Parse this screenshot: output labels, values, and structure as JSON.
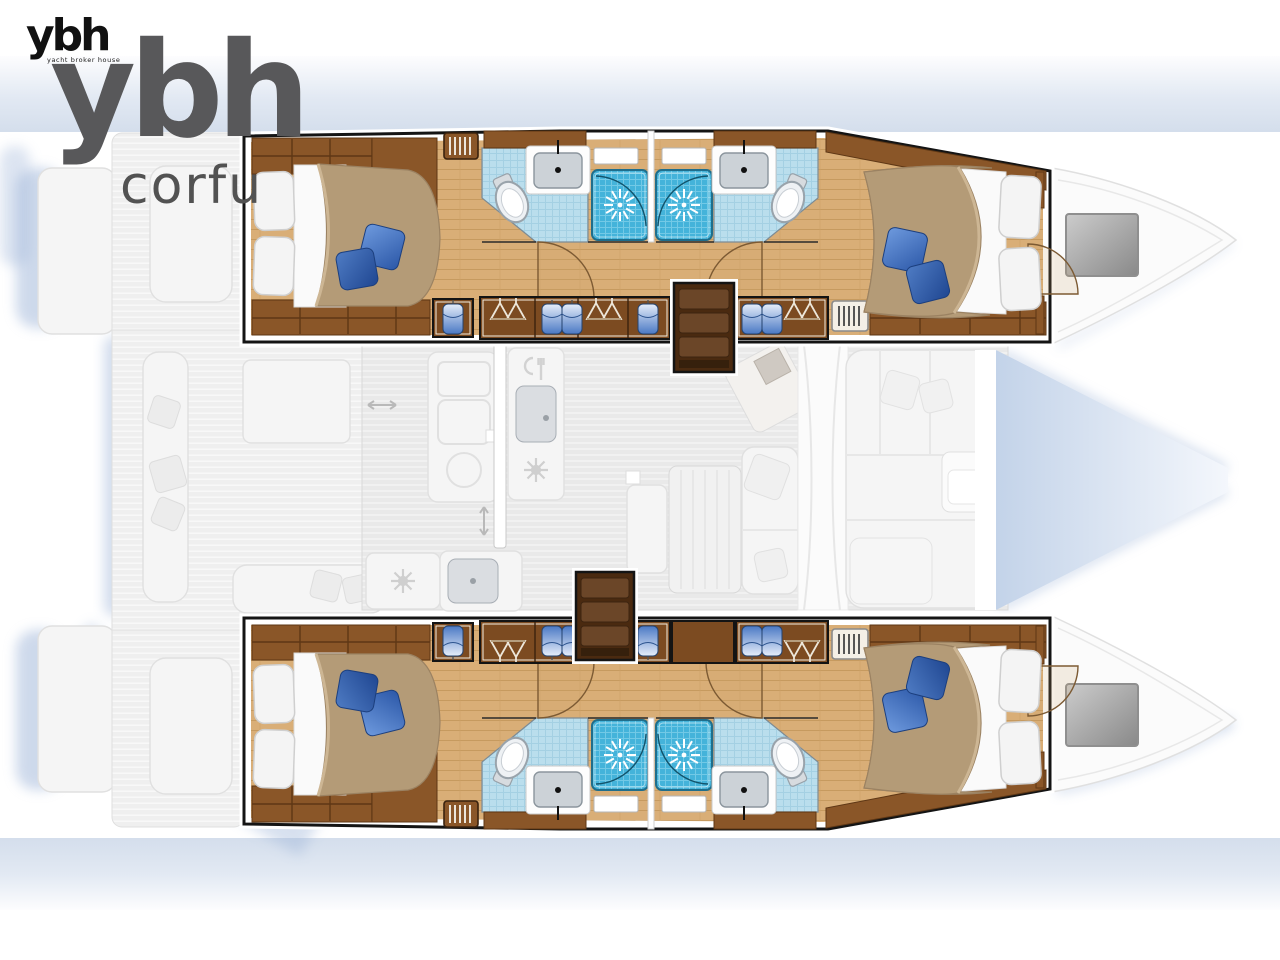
{
  "branding": {
    "logo_small_text": "ybh",
    "logo_small_tagline": "yacht broker house",
    "logo_watermark_text": "ybh",
    "logo_watermark_subtext": "corfu"
  },
  "diagram": {
    "type": "floor-plan",
    "subject": "catamaran yacht deck and cabin layout, top view",
    "highlighted": "four double cabins with en-suite bathrooms and showers in the two hulls",
    "faded": "central saloon with galley and dinette, aft cockpit, foredeck seating and bow trampoline",
    "counts": {
      "double_cabins": 4,
      "bathrooms": 4,
      "shower_stalls": 4,
      "toilets": 4,
      "companionway_steps": 2,
      "bow_hatches": 2
    }
  },
  "palette": {
    "outline": "#141414",
    "shadow": "#9db4d8",
    "wood_trim": "#8a5628",
    "wood_trim_dark": "#5e3715",
    "wood_floor": "#d9ae77",
    "steps_dark": "#4a2a10",
    "steps_tread": "#6b4628",
    "duvet_tan": "#b49b77",
    "duvet_edge": "#9b8262",
    "pillow_white": "#f4f4f4",
    "pillow_blue": "#3d6fc2",
    "pillow_blue_dark": "#2b57a7",
    "bath_tile": "#badeed",
    "shower_tile": "#44b3da",
    "faded_fill": "#f5f5f5",
    "faded_stroke": "#e0e0e0",
    "hatch_grey": "#9a9a9a",
    "band_blue": "#dce4f0",
    "logo_black": "#111111",
    "logo_grey": "#58585a",
    "corfu_grey": "#525252"
  }
}
